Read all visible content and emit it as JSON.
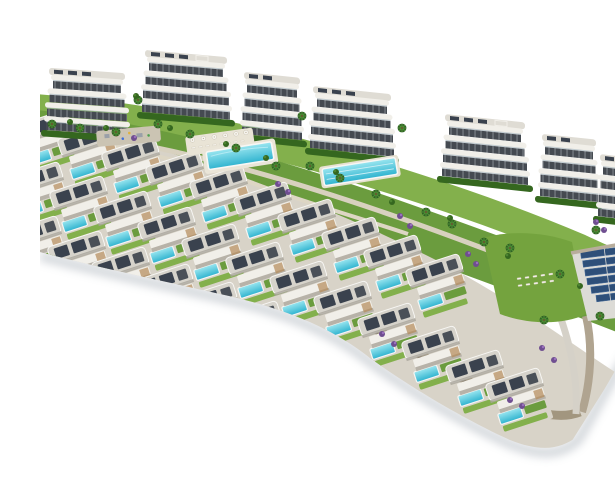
{
  "scene": {
    "title": "Aerial 3D render of a hillside residential development with apartment blocks, rows of villas with private pools, communal gardens, pools and a solar panel field on a white background",
    "background": "#ffffff",
    "counts": {
      "apartment_buildings": 6,
      "villa_rows": 3,
      "villas_visible": 28,
      "communal_pools": 2,
      "sunbed_terraces": 2,
      "solar_panel_rows": 6
    }
  },
  "colors": {
    "pool": "#3bbdd6",
    "pool_light": "#8fe2ee",
    "grass": "#6b9c3e",
    "grass_light": "#83b04c",
    "hedge": "#35671f",
    "wall_white": "#f1efe9",
    "wall_shadow": "#b7b2a8",
    "window_dark": "#454a51",
    "roof": "#d6d3cb",
    "solar": "#3a424e",
    "path": "#d8d1bf",
    "deck": "#d8d3c8",
    "purple": "#6f4e90",
    "stone": "#a2967f",
    "solar_field": "#2e4f79",
    "shadow": "#98a1ab"
  }
}
